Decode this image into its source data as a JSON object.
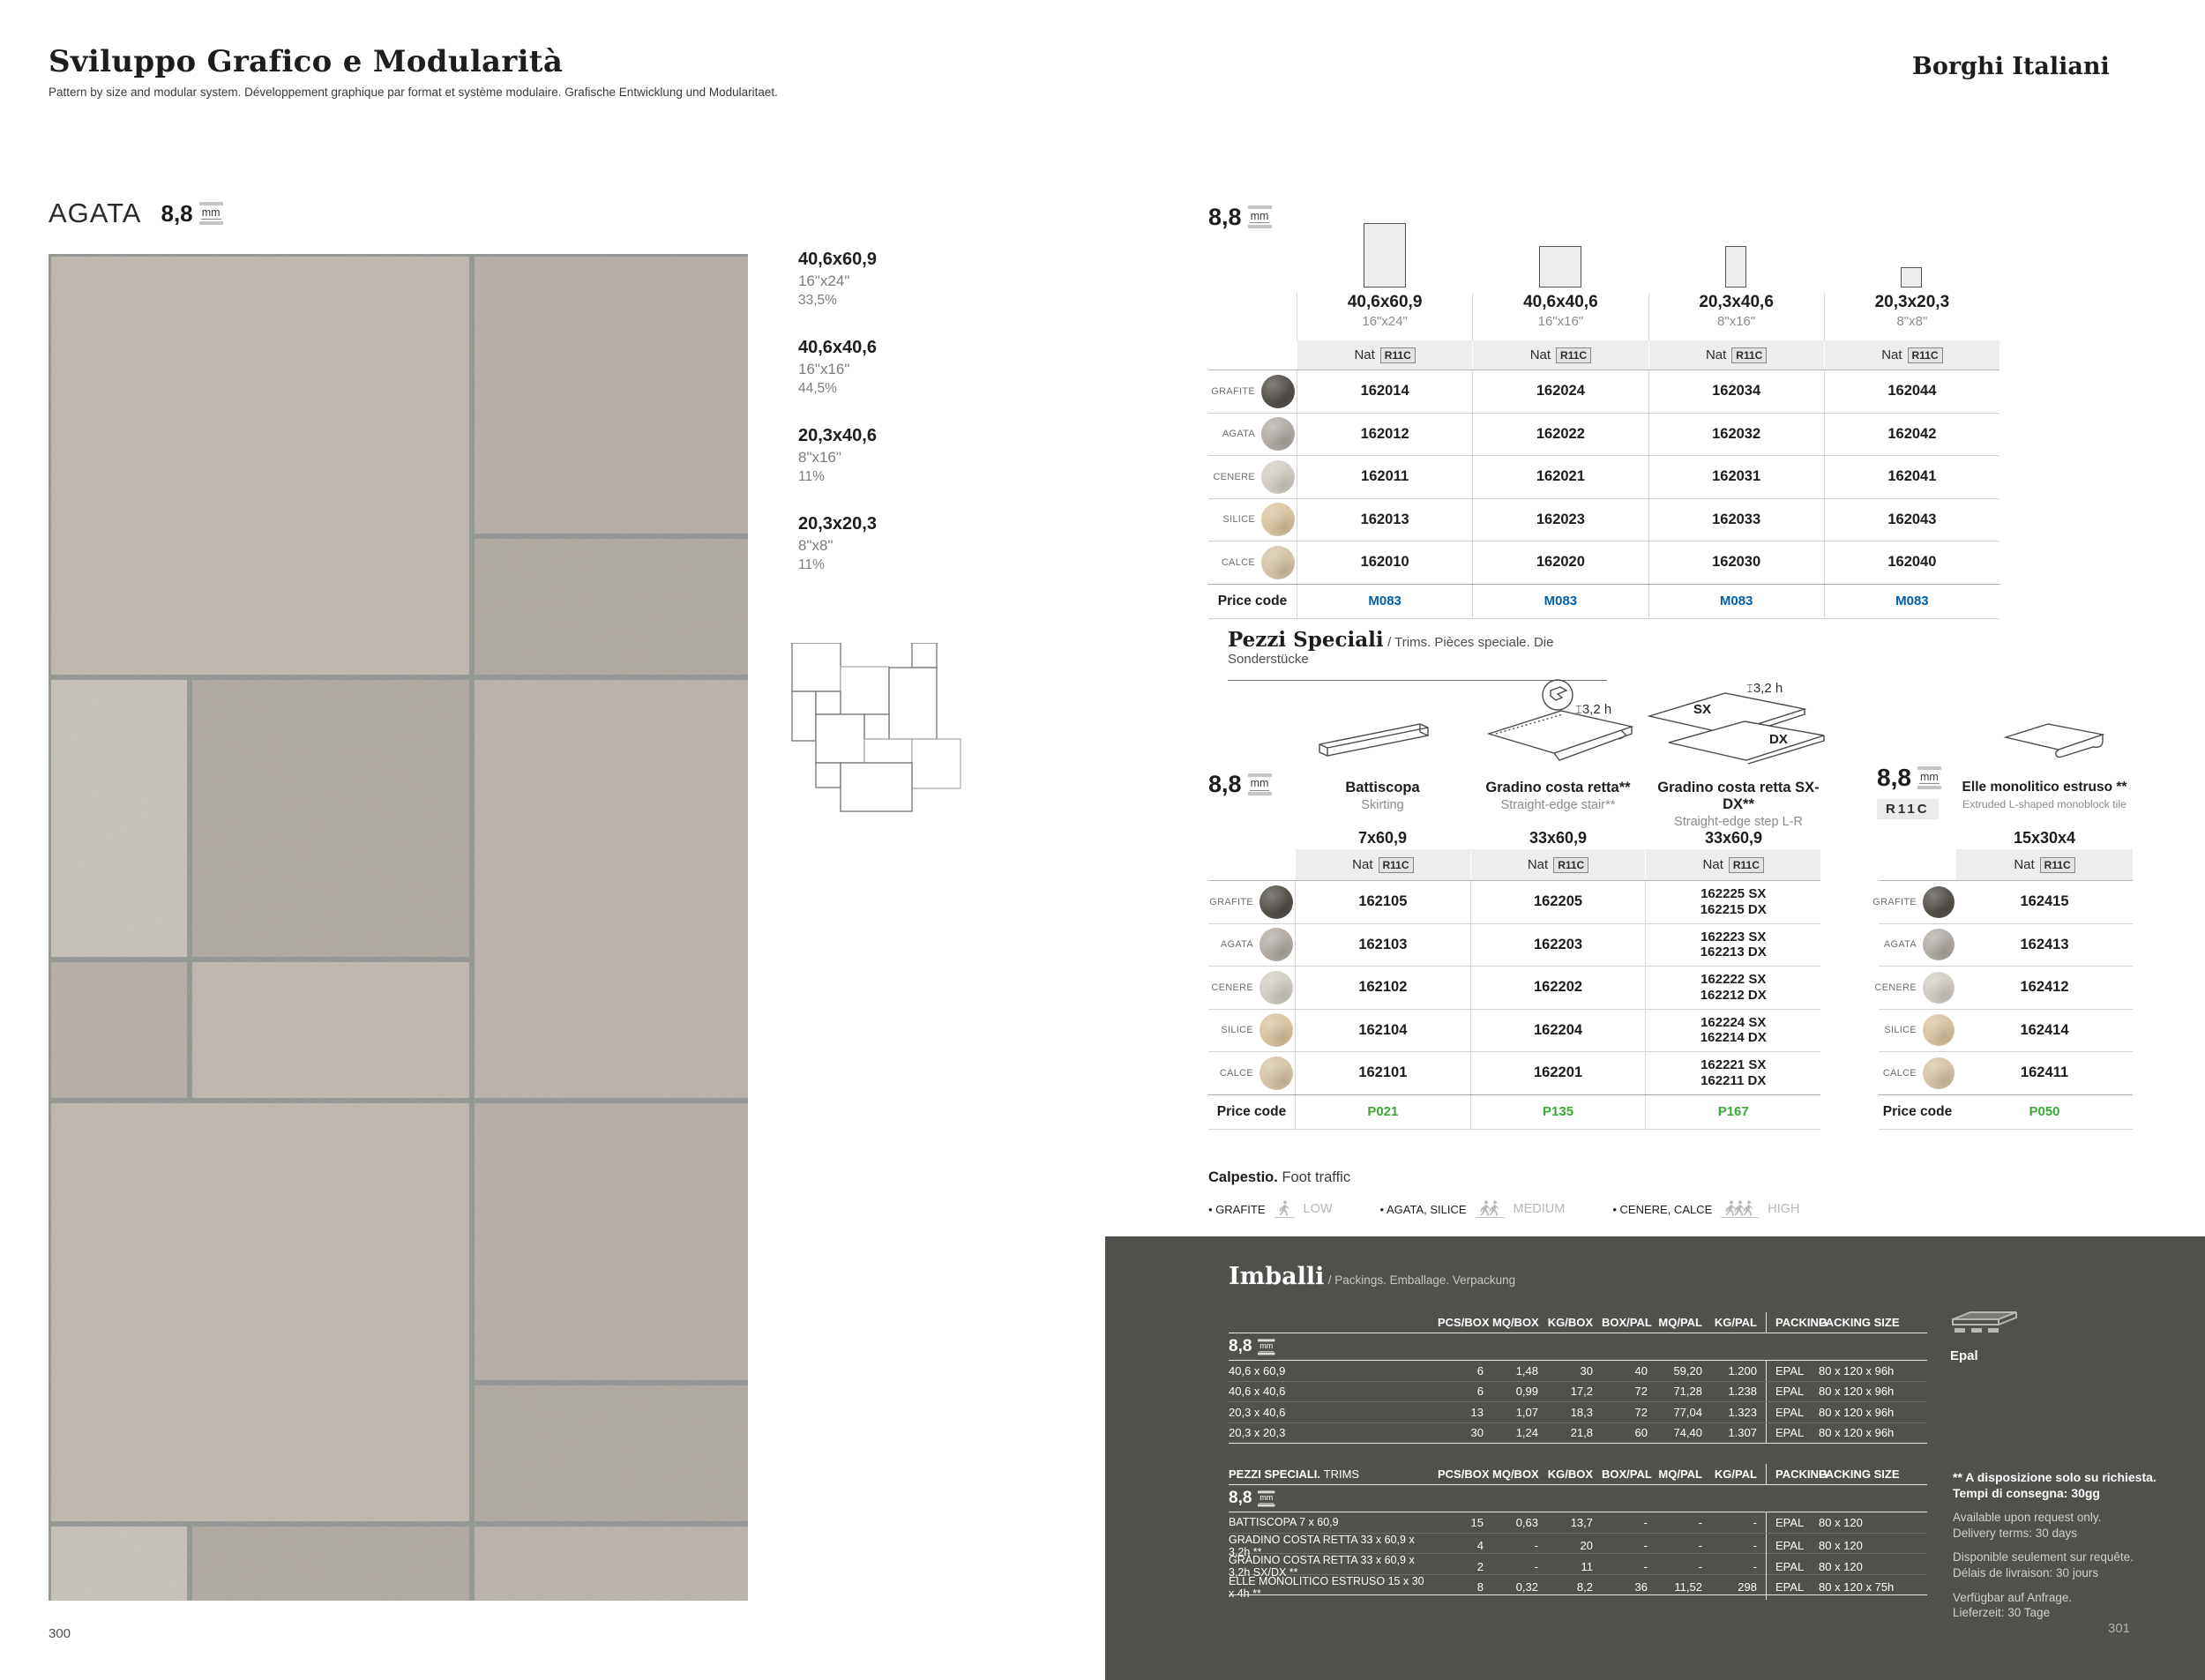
{
  "page": {
    "title": "Sviluppo Grafico e Modularità",
    "subtitle": "Pattern by size and modular system. Développement graphique par format et système modulaire. Grafische Entwicklung und Modularitaet.",
    "brand": "Borghi Italiani",
    "num_left": "300",
    "num_right": "301"
  },
  "labels": {
    "price": "Price code",
    "nat": "Nat",
    "slip": "R11C"
  },
  "series": {
    "name": "AGATA",
    "thickness": "8,8",
    "unit": "mm"
  },
  "sizes": [
    {
      "cm": "40,6x60,9",
      "inch": "16\"x24\"",
      "pct": "33,5%"
    },
    {
      "cm": "40,6x40,6",
      "inch": "16\"x16\"",
      "pct": "44,5%"
    },
    {
      "cm": "20,3x40,6",
      "inch": "8\"x16\"",
      "pct": "11%"
    },
    {
      "cm": "20,3x20,3",
      "inch": "8\"x8\"",
      "pct": "11%"
    }
  ],
  "colors": {
    "grafite": "#55504a",
    "agata": "#b3aca6",
    "cenere": "#d3cec4",
    "silice": "#d9c5a0",
    "calce": "#d6c5a8",
    "price_blue": "#0060ac",
    "price_green": "#3aaa35"
  },
  "main": {
    "thickness": "8,8",
    "cols": [
      {
        "cm": "40,6x60,9",
        "inch": "16\"x24\""
      },
      {
        "cm": "40,6x40,6",
        "inch": "16\"x16\""
      },
      {
        "cm": "20,3x40,6",
        "inch": "8\"x16\""
      },
      {
        "cm": "20,3x20,3",
        "inch": "8\"x8\""
      }
    ],
    "rows": [
      {
        "name": "GRAFITE",
        "codes": [
          "162014",
          "162024",
          "162034",
          "162044"
        ]
      },
      {
        "name": "AGATA",
        "codes": [
          "162012",
          "162022",
          "162032",
          "162042"
        ]
      },
      {
        "name": "CENERE",
        "codes": [
          "162011",
          "162021",
          "162031",
          "162041"
        ]
      },
      {
        "name": "SILICE",
        "codes": [
          "162013",
          "162023",
          "162033",
          "162043"
        ]
      },
      {
        "name": "CALCE",
        "codes": [
          "162010",
          "162020",
          "162030",
          "162040"
        ]
      }
    ],
    "prices": [
      "M083",
      "M083",
      "M083",
      "M083"
    ]
  },
  "ps": {
    "title": "Pezzi Speciali",
    "sub": "/ Trims. Pièces speciale. Die Sonderstücke",
    "thickness": "8,8",
    "h": "3,2 h",
    "sx": "SX",
    "dx": "DX",
    "items": [
      {
        "name": "Battiscopa",
        "sub": "Skirting",
        "size": "7x60,9"
      },
      {
        "name": "Gradino costa retta**",
        "sub": "Straight-edge stair**",
        "size": "33x60,9"
      },
      {
        "name": "Gradino costa retta SX-DX**",
        "sub": "Straight-edge step L-R",
        "size": "33x60,9"
      }
    ],
    "rows": [
      {
        "name": "GRAFITE",
        "c1": "162105",
        "c2": "162205",
        "c3a": "162225 SX",
        "c3b": "162215 DX"
      },
      {
        "name": "AGATA",
        "c1": "162103",
        "c2": "162203",
        "c3a": "162223 SX",
        "c3b": "162213 DX"
      },
      {
        "name": "CENERE",
        "c1": "162102",
        "c2": "162202",
        "c3a": "162222 SX",
        "c3b": "162212 DX"
      },
      {
        "name": "SILICE",
        "c1": "162104",
        "c2": "162204",
        "c3a": "162224 SX",
        "c3b": "162214 DX"
      },
      {
        "name": "CALCE",
        "c1": "162101",
        "c2": "162201",
        "c3a": "162221 SX",
        "c3b": "162211 DX"
      }
    ],
    "prices": [
      "P021",
      "P135",
      "P167"
    ]
  },
  "elle": {
    "thickness": "8,8",
    "badge": "R11C",
    "name": "Elle monolitico estruso **",
    "sub": "Extruded L-shaped monoblock tile",
    "size": "15x30x4",
    "rows": [
      {
        "name": "GRAFITE",
        "code": "162415"
      },
      {
        "name": "AGATA",
        "code": "162413"
      },
      {
        "name": "CENERE",
        "code": "162412"
      },
      {
        "name": "SILICE",
        "code": "162414"
      },
      {
        "name": "CALCE",
        "code": "162411"
      }
    ],
    "price": "P050"
  },
  "foot": {
    "label": "Calpestio.",
    "en": "Foot traffic",
    "items": [
      {
        "names": "GRAFITE",
        "level": "LOW"
      },
      {
        "names": "AGATA, SILICE",
        "level": "MEDIUM"
      },
      {
        "names": "CENERE, CALCE",
        "level": "HIGH"
      }
    ]
  },
  "pack": {
    "title": "Imballi",
    "sub": "/ Packings. Emballage. Verpackung",
    "thickness": "8,8",
    "headers": [
      "PCS/BOX",
      "MQ/BOX",
      "KG/BOX",
      "BOX/PAL",
      "MQ/PAL",
      "KG/PAL",
      "PACKING",
      "PACKING SIZE"
    ],
    "rows": [
      {
        "name": "40,6 x 60,9",
        "v": [
          "6",
          "1,48",
          "30",
          "40",
          "59,20",
          "1.200"
        ],
        "pk": "EPAL",
        "ps": "80 x 120 x 96h"
      },
      {
        "name": "40,6 x 40,6",
        "v": [
          "6",
          "0,99",
          "17,2",
          "72",
          "71,28",
          "1.238"
        ],
        "pk": "EPAL",
        "ps": "80 x 120 x 96h"
      },
      {
        "name": "20,3 x 40,6",
        "v": [
          "13",
          "1,07",
          "18,3",
          "72",
          "77,04",
          "1.323"
        ],
        "pk": "EPAL",
        "ps": "80 x 120 x 96h"
      },
      {
        "name": "20,3 x 20,3",
        "v": [
          "30",
          "1,24",
          "21,8",
          "60",
          "74,40",
          "1.307"
        ],
        "pk": "EPAL",
        "ps": "80 x 120 x 96h"
      }
    ],
    "trims_title": "PEZZI SPECIALI.",
    "trims_sub": "TRIMS",
    "trows": [
      {
        "name": "BATTISCOPA 7 x 60,9",
        "v": [
          "15",
          "0,63",
          "13,7",
          "-",
          "-",
          "-"
        ],
        "pk": "EPAL",
        "ps": "80 x 120"
      },
      {
        "name": "GRADINO COSTA RETTA 33 x 60,9 x 3,2h **",
        "v": [
          "4",
          "-",
          "20",
          "-",
          "-",
          "-"
        ],
        "pk": "EPAL",
        "ps": "80 x 120"
      },
      {
        "name": "GRADINO COSTA RETTA 33 x 60,9 x 3,2h SX/DX **",
        "v": [
          "2",
          "-",
          "11",
          "-",
          "-",
          "-"
        ],
        "pk": "EPAL",
        "ps": "80 x 120"
      },
      {
        "name": "ELLE MONOLITICO ESTRUSO 15 x 30 x 4h **",
        "v": [
          "8",
          "0,32",
          "8,2",
          "36",
          "11,52",
          "298"
        ],
        "pk": "EPAL",
        "ps": "80 x 120 x 75h"
      }
    ],
    "epal": "Epal",
    "note1": "** A disposizione solo su richiesta.",
    "note2": "Tempi di consegna: 30gg",
    "notes": [
      "Available upon request only.",
      "Delivery terms: 30 days",
      "Disponible seulement sur requête.",
      "Délais de livraison: 30 jours",
      "Verfügbar auf Anfrage.",
      "Lieferzeit: 30 Tage"
    ]
  }
}
